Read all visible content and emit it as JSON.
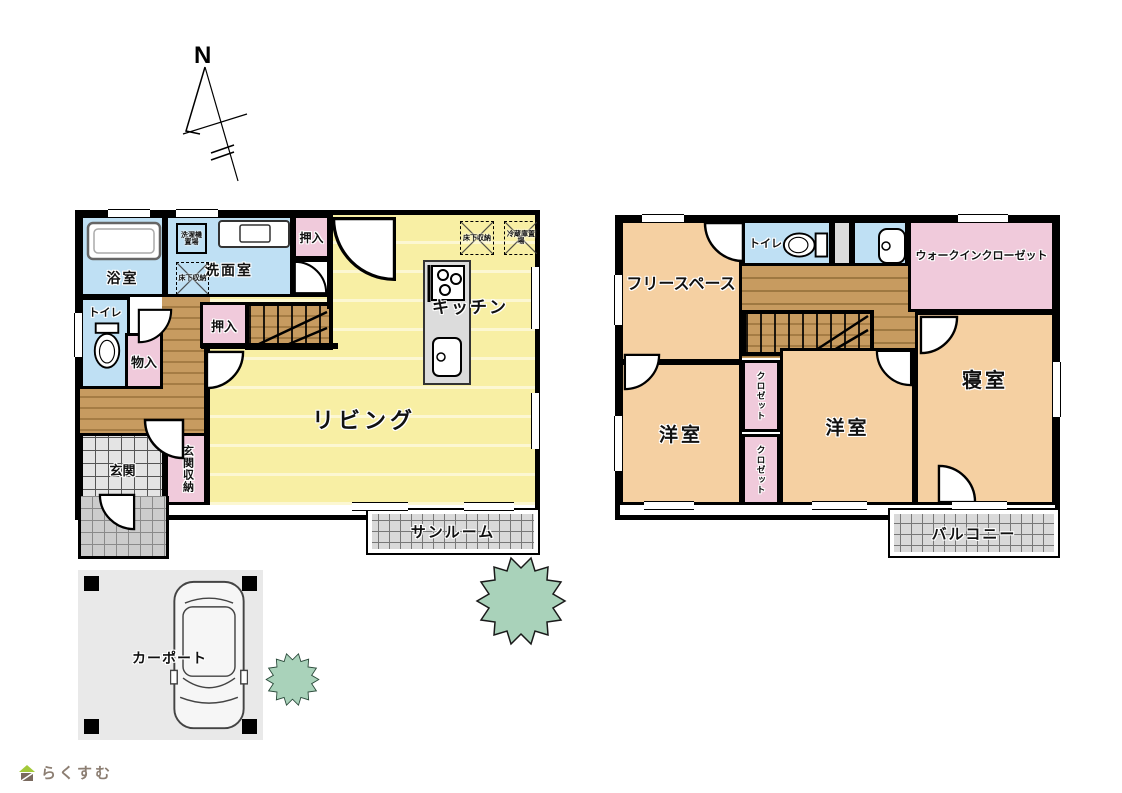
{
  "compass": {
    "north": "N"
  },
  "floor1": {
    "bath": "浴室",
    "washroom": "洗面室",
    "oshiire_top": "押入",
    "oshiire_mid": "押入",
    "toilet": "トイレ",
    "monoire": "物入",
    "kitchen": "キッチン",
    "living": "リビング",
    "genkan": "玄関",
    "genkan_storage": "玄関収納",
    "sunroom": "サンルーム",
    "laundry": "洗濯機置場",
    "underfloor_wash": "床下収納",
    "underfloor_kitchen": "床下収納",
    "fridge": "冷蔵庫置場"
  },
  "floor2": {
    "free_space": "フリースペース",
    "toilet": "トイレ",
    "wic": "ウォークインクローゼット",
    "yoshitsu1": "洋室",
    "yoshitsu2": "洋室",
    "shinshitsu": "寝室",
    "closet1": "クロゼット",
    "closet2": "クロゼット",
    "balcony": "バルコニー"
  },
  "site": {
    "carport": "カーポート"
  },
  "logo": {
    "brand": "らくすむ"
  },
  "colors": {
    "living_yellow": "#F8EFA4",
    "wet_blue": "#BFE0F4",
    "closet_pink": "#F0CADB",
    "room_tan": "#F5D0A2",
    "wood_floor": "#C79B60",
    "tree_green": "#A9D2BA",
    "logo_brown": "#8C7E72"
  }
}
